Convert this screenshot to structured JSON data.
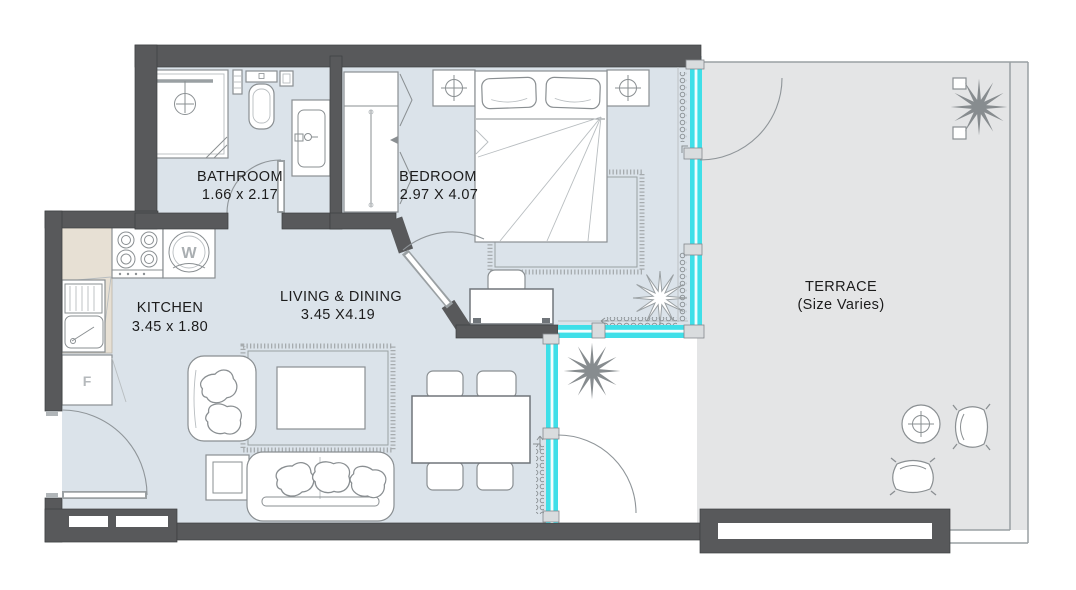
{
  "plan": {
    "rooms": {
      "bathroom": {
        "name": "BATHROOM",
        "dimensions": "1.66 x 2.17"
      },
      "bedroom": {
        "name": "BEDROOM",
        "dimensions": "2.97 X 4.07"
      },
      "kitchen": {
        "name": "KITCHEN",
        "dimensions": "3.45 x 1.80"
      },
      "living_dining": {
        "name": "LIVING & DINING",
        "dimensions": "3.45 X4.19"
      },
      "terrace": {
        "name": "TERRACE",
        "dimensions": "(Size Varies)"
      }
    },
    "appliances": {
      "washer_label": "W",
      "fridge_label": "F"
    },
    "colors": {
      "wall": "#58595b",
      "interior_floor": "#dbe3ea",
      "terrace_floor": "#e4e5e6",
      "glass_accent": "#3fdfe8",
      "kitchen_counter": "#e7e0d4",
      "furniture_outline": "#8a8f92"
    }
  }
}
